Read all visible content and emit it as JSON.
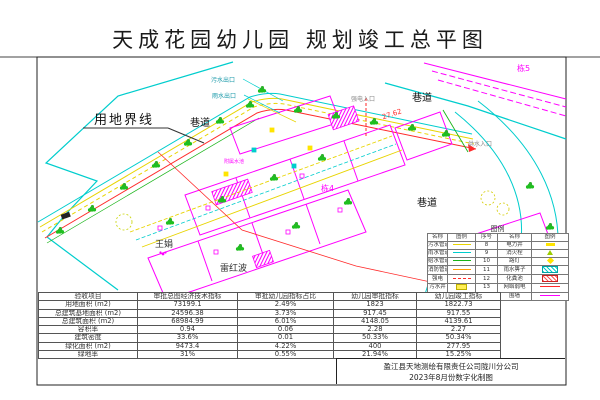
{
  "title": "天成花园幼儿园 规划竣工总平图",
  "map": {
    "labels": {
      "boundary": "用地界线",
      "alley": "巷道",
      "sewage_outlet": "污水出口",
      "rain_outlet": "雨水出口",
      "power_inlet": "强电入口",
      "water_inlet": "供水入口",
      "building4": "栋4",
      "building5": "栋5",
      "owner1": "王娟",
      "owner2": "雷红波",
      "annex_pool": "附属水池",
      "elevation": "27.62"
    },
    "colors": {
      "boundary_cyan": "#00cdcd",
      "building_magenta": "#ff00ff",
      "road_red": "#ff2a2a",
      "utility_yellow": "#e8d400",
      "tree_green": "#1fbf1f"
    }
  },
  "legend": {
    "title": "图例",
    "headers": [
      "名称",
      "图例",
      "序号",
      "名称",
      "图例"
    ],
    "rows": [
      {
        "left_name": "污水管道",
        "left_symbol": "yellow-line",
        "no": "8",
        "right_name": "电力井",
        "right_symbol": "yellow-dash"
      },
      {
        "left_name": "雨水管道",
        "left_symbol": "cyan-line",
        "no": "9",
        "right_name": "消火栓",
        "right_symbol": "hydrant-triangle"
      },
      {
        "left_name": "给水管道",
        "left_symbol": "green-line",
        "no": "10",
        "right_name": "路灯",
        "right_symbol": "lamp-mark"
      },
      {
        "left_name": "消防管道",
        "left_symbol": "orange-line",
        "no": "11",
        "right_name": "雨水箅子",
        "right_symbol": "cyan-hatch"
      },
      {
        "left_name": "强电",
        "left_symbol": "red-dash",
        "no": "12",
        "right_name": "化粪池",
        "right_symbol": "red-hatch"
      },
      {
        "left_name": "污水井",
        "left_symbol": "yellow-box",
        "no": "13",
        "right_name": "网络弱电",
        "right_symbol": "red-line"
      },
      {
        "left_name": "雨水井",
        "left_symbol": "cyan-box",
        "no": "14",
        "right_name": "围墙",
        "right_symbol": "magenta-line"
      }
    ]
  },
  "table": {
    "headers": [
      "验收项目",
      "审批总图经济技术指标",
      "审批幼儿园指标占比",
      "幼儿园审批指标",
      "幼儿园竣工指标"
    ],
    "rows": [
      [
        "用地面积 (m2)",
        "73199.1",
        "2.49%",
        "1823",
        "1822.73"
      ],
      [
        "总建筑基地面积 (m2)",
        "24596.38",
        "3.73%",
        "917.45",
        "917.55"
      ],
      [
        "总建筑面积 (m2)",
        "68984.99",
        "6.01%",
        "4148.05",
        "4139.61"
      ],
      [
        "容积率",
        "0.94",
        "0.06",
        "2.28",
        "2.27"
      ],
      [
        "建筑密度",
        "33.6%",
        "0.01",
        "50.33%",
        "50.34%"
      ],
      [
        "绿化面积 (m2)",
        "9473.4",
        "4.22%",
        "400",
        "277.95"
      ],
      [
        "绿地率",
        "31%",
        "0.55%",
        "21.94%",
        "15.25%"
      ]
    ]
  },
  "footer": {
    "company": "盈江县天地测绘有限责任公司陇川分公司",
    "date_note": "2023年8月份数字化制图"
  }
}
